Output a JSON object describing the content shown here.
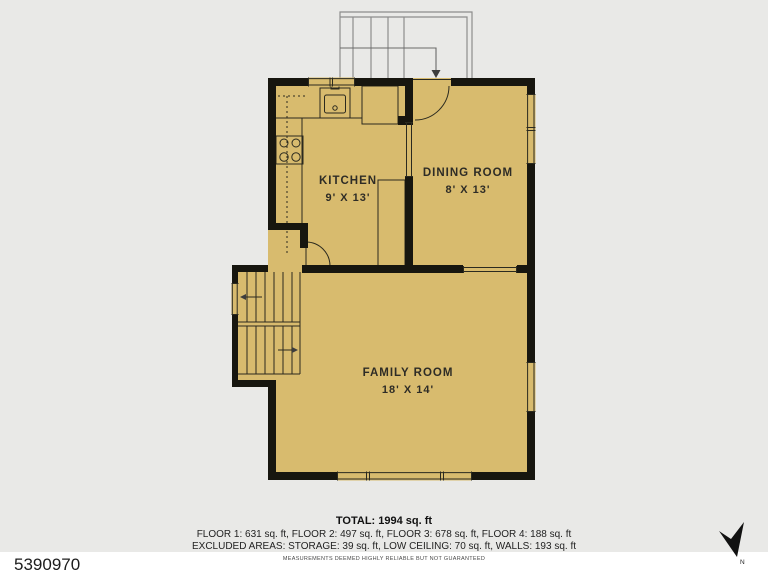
{
  "colors": {
    "background": "#e9e9e7",
    "floor": "#d8bb6e",
    "wall": "#17160f",
    "line": "#2b2a1f",
    "stairs": "#8d8d8d",
    "strip": "#ffffff"
  },
  "rooms": [
    {
      "name": "KITCHEN",
      "dims": "9' X 13'"
    },
    {
      "name": "DINING ROOM",
      "dims": "8' X 13'"
    },
    {
      "name": "FAMILY ROOM",
      "dims": "18' X 14'"
    }
  ],
  "summary": {
    "total": "TOTAL: 1994 sq. ft",
    "floors": "FLOOR 1: 631 sq. ft, FLOOR 2: 497 sq. ft, FLOOR 3: 678 sq. ft, FLOOR 4: 188 sq. ft",
    "excluded": "EXCLUDED AREAS: STORAGE: 39 sq. ft, LOW CEILING: 70 sq. ft, WALLS: 193 sq. ft",
    "disclaimer": "MEASUREMENTS DEEMED HIGHLY RELIABLE BUT NOT GUARANTEED"
  },
  "footer": {
    "mls_number": "5390970"
  },
  "compass": {
    "label": "N"
  }
}
